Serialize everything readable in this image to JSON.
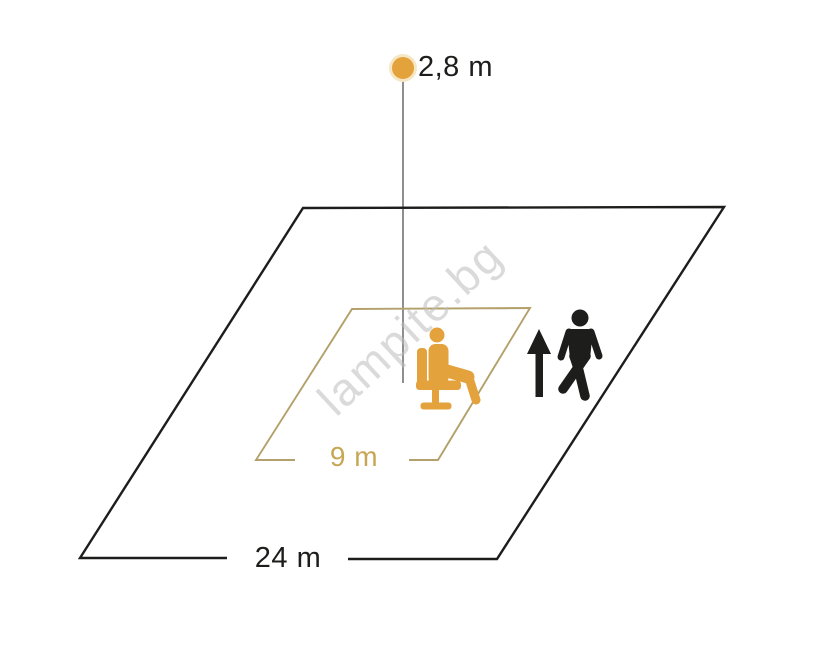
{
  "colors": {
    "background": "#ffffff",
    "black": "#1d1d1b",
    "tan_line": "#b3a06a",
    "gold_text": "#c7a654",
    "orange": "#e3a23c",
    "orange_halo": "#f6e7c4",
    "gray_line": "#8f8f8f",
    "watermark": "#bdbdbd"
  },
  "sensor": {
    "height_label": "2,8 m"
  },
  "outer_zone": {
    "size_label": "24 m"
  },
  "inner_zone": {
    "size_label": "9 m"
  },
  "icons": {
    "sensor_dot": "filled-circle",
    "up_arrow": "↑",
    "seated_person": "person-seated-on-chair-pictogram",
    "walking_person": "walking-person-pictogram"
  },
  "watermark": {
    "text": "lampite.bg"
  }
}
